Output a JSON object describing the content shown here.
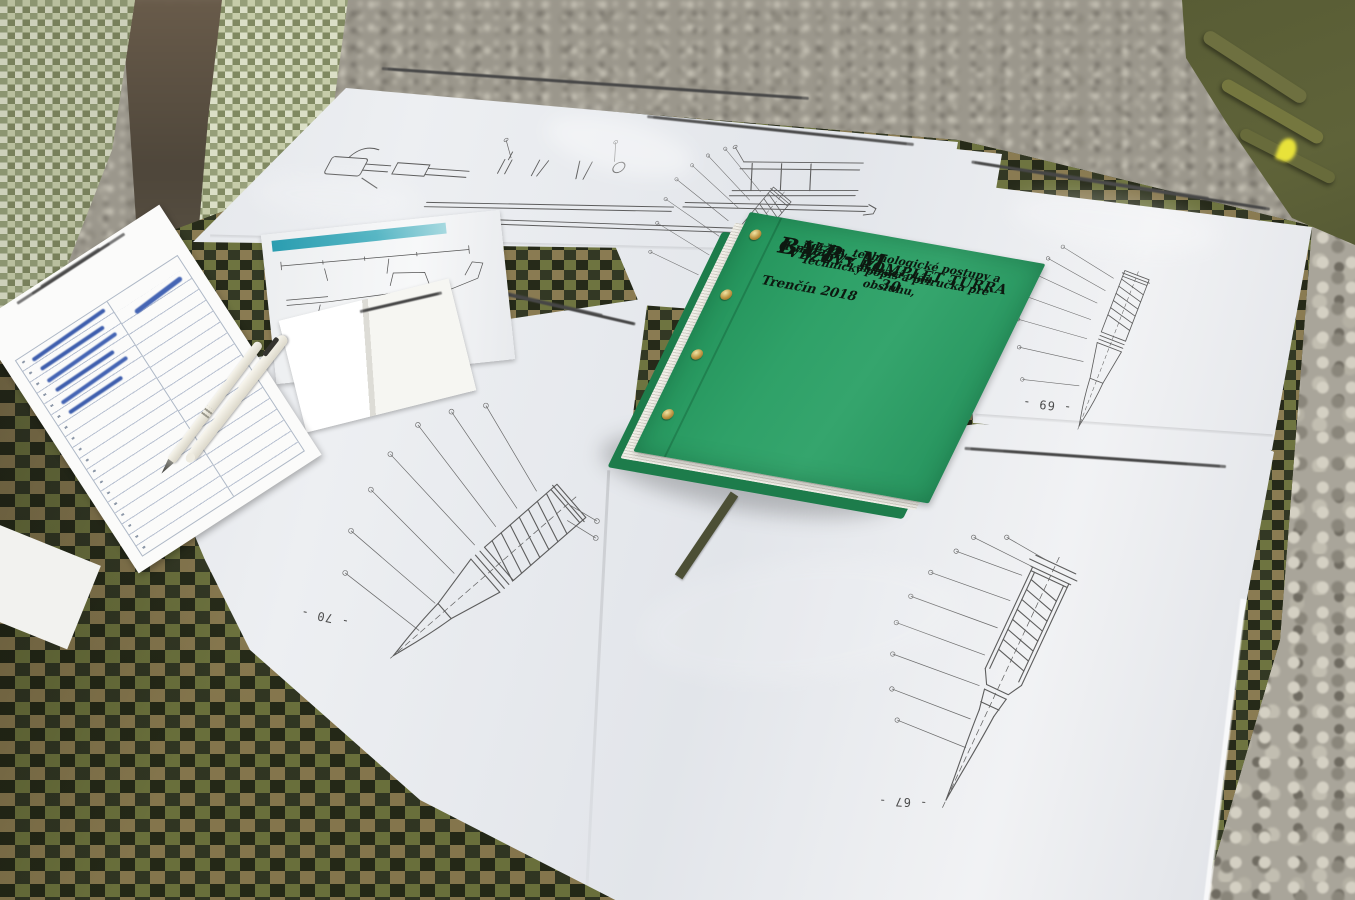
{
  "book_cover": {
    "code": "BVP–M",
    "title": "VEŽOVÝ KOMPLET TURRA 30",
    "volume": "(Kniha 3)",
    "subtitle_line1": "Technický popis a príručka pre obsluhu,",
    "subtitle_line2": "údržba, technologické postupy a mazací plán",
    "imprint": "Trenčín 2018",
    "cover_color": "#2e9c63",
    "text_color": "#0d1810"
  },
  "laminated_pages": {
    "page_number_bottom_left": "- 70 -",
    "page_number_right": "- 69 -",
    "page_number_bottom_center": "- 67 -"
  },
  "palette": {
    "gravel": "#9b978c",
    "tablecloth_camo_colors": [
      "#6e7440",
      "#333824",
      "#8a7b52",
      "#262a19"
    ],
    "light_fabric_camo_colors": [
      "#b9bf9e",
      "#78805b",
      "#cdd0ba",
      "#8c9571"
    ],
    "backpack_olive": "#565a33",
    "pen_white": "#ece9df",
    "handwriting_ink": "#3f5fae",
    "manual_accent_stripe": "#2a9db0"
  }
}
